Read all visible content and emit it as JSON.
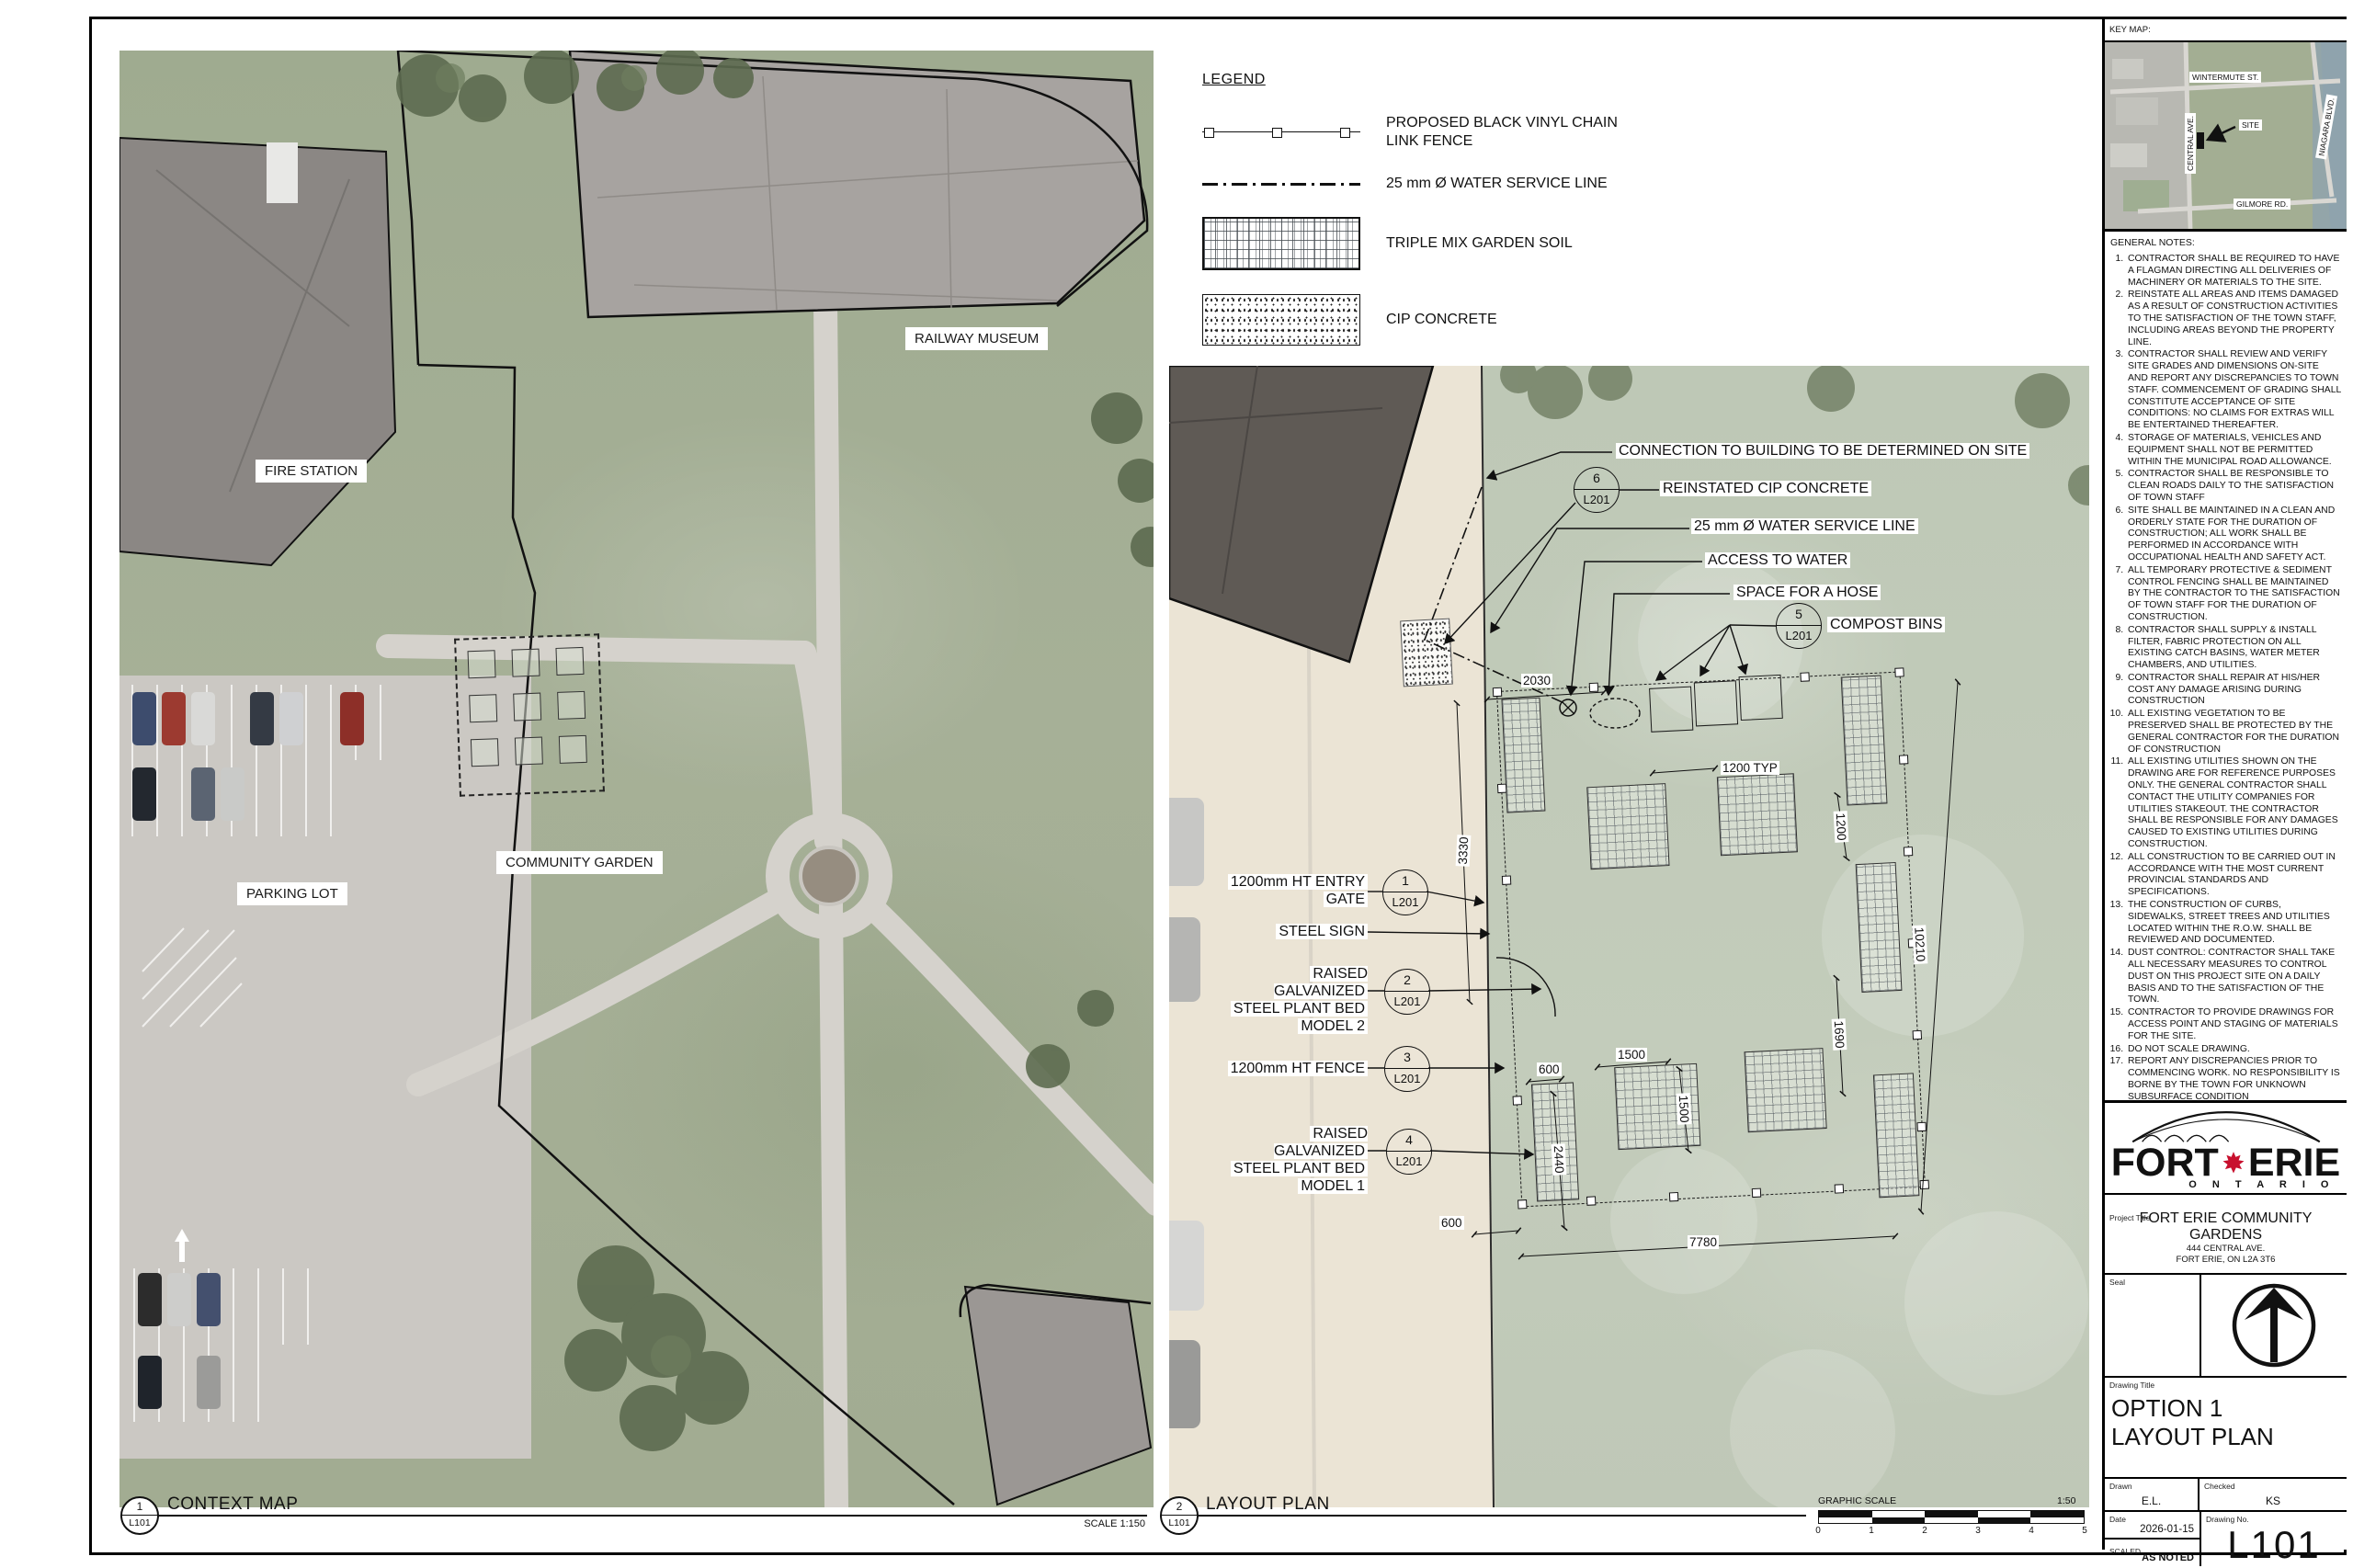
{
  "legend": {
    "title": "LEGEND",
    "items": [
      {
        "symbol": "chain-link-fence-symbol",
        "lines": [
          "PROPOSED BLACK VINYL CHAIN",
          "LINK FENCE"
        ]
      },
      {
        "symbol": "water-service-line-symbol",
        "lines": [
          "25 mm Ø WATER SERVICE LINE"
        ]
      },
      {
        "symbol": "garden-soil-hatch-symbol",
        "lines": [
          "TRIPLE MIX GARDEN SOIL"
        ]
      },
      {
        "symbol": "cip-concrete-stipple-symbol",
        "lines": [
          "CIP CONCRETE"
        ]
      }
    ]
  },
  "context_map": {
    "labels": {
      "fire_station": "FIRE STATION",
      "railway_museum": "RAILWAY MUSEUM",
      "parking_lot": "PARKING LOT",
      "community_garden": "COMMUNITY GARDEN"
    }
  },
  "plan": {
    "callouts_top": [
      {
        "text": "CONNECTION TO BUILDING TO BE DETERMINED ON SITE"
      },
      {
        "ref": "6",
        "sheet": "L201",
        "text": "REINSTATED CIP CONCRETE"
      },
      {
        "text": "25 mm Ø WATER SERVICE LINE"
      },
      {
        "text": "ACCESS TO WATER"
      },
      {
        "text": "SPACE FOR A HOSE"
      },
      {
        "ref": "5",
        "sheet": "L201",
        "text": "COMPOST BINS"
      }
    ],
    "callouts_left": [
      {
        "ref": "1",
        "sheet": "L201",
        "lines": [
          "1200mm HT ENTRY",
          "GATE"
        ]
      },
      {
        "lines": [
          "STEEL SIGN"
        ]
      },
      {
        "ref": "2",
        "sheet": "L201",
        "lines": [
          "RAISED GALVANIZED",
          "STEEL PLANT BED",
          "MODEL 2"
        ]
      },
      {
        "ref": "3",
        "sheet": "L201",
        "lines": [
          "1200mm HT FENCE"
        ]
      },
      {
        "ref": "4",
        "sheet": "L201",
        "lines": [
          "RAISED GALVANIZED",
          "STEEL PLANT BED",
          "MODEL 1"
        ]
      }
    ],
    "dimensions": {
      "top": "2030",
      "left_v": "3330",
      "typ": "1200 TYP",
      "right_1200": "1200",
      "right_10210": "10210",
      "right_1690": "1690",
      "mid_600": "600",
      "c1500h": "1500",
      "c1500v": "1500",
      "c2440": "2440",
      "bottom_600": "600",
      "bottom_7780": "7780"
    }
  },
  "key_map": {
    "title": "KEY MAP:",
    "site": "SITE",
    "streets": {
      "wintermute": "WINTERMUTE ST.",
      "central": "CENTRAL AVE.",
      "niagara": "NIAGARA BLVD.",
      "gilmore": "GILMORE RD."
    }
  },
  "general_notes": {
    "title": "GENERAL NOTES:",
    "items": [
      "CONTRACTOR SHALL BE REQUIRED TO HAVE A FLAGMAN DIRECTING ALL DELIVERIES OF MACHINERY OR MATERIALS TO THE SITE.",
      "REINSTATE ALL AREAS AND ITEMS DAMAGED AS A RESULT OF CONSTRUCTION ACTIVITIES TO THE SATISFACTION OF THE TOWN STAFF, INCLUDING AREAS BEYOND THE PROPERTY LINE.",
      "CONTRACTOR SHALL REVIEW AND VERIFY SITE GRADES AND DIMENSIONS ON-SITE AND REPORT ANY DISCREPANCIES TO TOWN STAFF. COMMENCEMENT OF GRADING SHALL CONSTITUTE ACCEPTANCE OF SITE CONDITIONS: NO CLAIMS FOR EXTRAS WILL BE ENTERTAINED THEREAFTER.",
      "STORAGE OF MATERIALS, VEHICLES AND EQUIPMENT SHALL NOT BE PERMITTED WITHIN THE MUNICIPAL ROAD ALLOWANCE.",
      "CONTRACTOR SHALL BE RESPONSIBLE TO CLEAN ROADS DAILY TO THE SATISFACTION OF TOWN STAFF",
      "SITE SHALL BE MAINTAINED IN A CLEAN AND ORDERLY STATE FOR THE DURATION OF CONSTRUCTION; ALL WORK SHALL BE PERFORMED IN ACCORDANCE WITH OCCUPATIONAL HEALTH AND SAFETY ACT.",
      "ALL TEMPORARY PROTECTIVE & SEDIMENT CONTROL FENCING SHALL BE MAINTAINED BY THE CONTRACTOR TO THE SATISFACTION OF TOWN STAFF FOR THE DURATION OF CONSTRUCTION.",
      "CONTRACTOR SHALL SUPPLY & INSTALL FILTER, FABRIC PROTECTION ON ALL EXISTING CATCH BASINS, WATER METER CHAMBERS, AND UTILITIES.",
      "CONTRACTOR SHALL REPAIR AT HIS/HER COST ANY DAMAGE ARISING DURING CONSTRUCTION",
      "ALL EXISTING VEGETATION TO BE PRESERVED SHALL BE PROTECTED BY THE GENERAL CONTRACTOR FOR THE DURATION OF CONSTRUCTION",
      "ALL EXISTING UTILITIES SHOWN ON THE DRAWING ARE FOR REFERENCE PURPOSES ONLY. THE GENERAL CONTRACTOR SHALL CONTACT THE UTILITY COMPANIES FOR UTILITIES STAKEOUT. THE CONTRACTOR SHALL BE RESPONSIBLE FOR ANY DAMAGES CAUSED TO EXISTING UTILITIES DURING CONSTRUCTION.",
      "ALL CONSTRUCTION TO BE CARRIED OUT IN ACCORDANCE WITH THE MOST CURRENT PROVINCIAL STANDARDS AND SPECIFICATIONS.",
      "THE CONSTRUCTION OF CURBS, SIDEWALKS, STREET TREES AND UTILITIES LOCATED WITHIN THE R.O.W. SHALL BE REVIEWED AND DOCUMENTED.",
      "DUST CONTROL: CONTRACTOR SHALL TAKE ALL NECESSARY MEASURES TO CONTROL DUST ON THIS PROJECT SITE ON A DAILY BASIS AND TO THE SATISFACTION OF THE TOWN.",
      "CONTRACTOR TO PROVIDE DRAWINGS FOR ACCESS POINT AND STAGING OF MATERIALS FOR THE SITE.",
      "DO NOT SCALE DRAWING.",
      "REPORT ANY DISCREPANCIES PRIOR TO COMMENCING WORK. NO RESPONSIBILITY IS BORNE BY THE TOWN FOR UNKNOWN SUBSURFACE CONDITION"
    ]
  },
  "title_block": {
    "logo": {
      "word1": "FORT",
      "word2": "ERIE",
      "subtitle": "O N T A R I O"
    },
    "project": {
      "label": "Project Title",
      "name": "FORT ERIE COMMUNITY GARDENS",
      "address1": "444 CENTRAL AVE.",
      "address2": "FORT ERIE, ON L2A 3T6"
    },
    "seal_label": "Seal",
    "drawing": {
      "label": "Drawing Title",
      "line1": "OPTION 1",
      "line2": "LAYOUT PLAN"
    },
    "drawn": {
      "label": "Drawn",
      "value": "E.L."
    },
    "checked": {
      "label": "Checked",
      "value": "KS"
    },
    "date": {
      "label": "Date",
      "value": "2026-01-15"
    },
    "scaled": {
      "label": "SCALED",
      "value": "AS NOTED"
    },
    "number": {
      "label": "Drawing No.",
      "value": "L101"
    }
  },
  "footer": {
    "view1": {
      "num": "1",
      "sheet": "L101",
      "title": "CONTEXT MAP",
      "scale": "SCALE 1:150"
    },
    "view2": {
      "num": "2",
      "sheet": "L101",
      "title": "LAYOUT PLAN"
    },
    "graphic_scale": {
      "label": "GRAPHIC SCALE",
      "ratio": "1:50",
      "ticks": [
        "0",
        "1",
        "2",
        "3",
        "4",
        "5"
      ]
    }
  }
}
